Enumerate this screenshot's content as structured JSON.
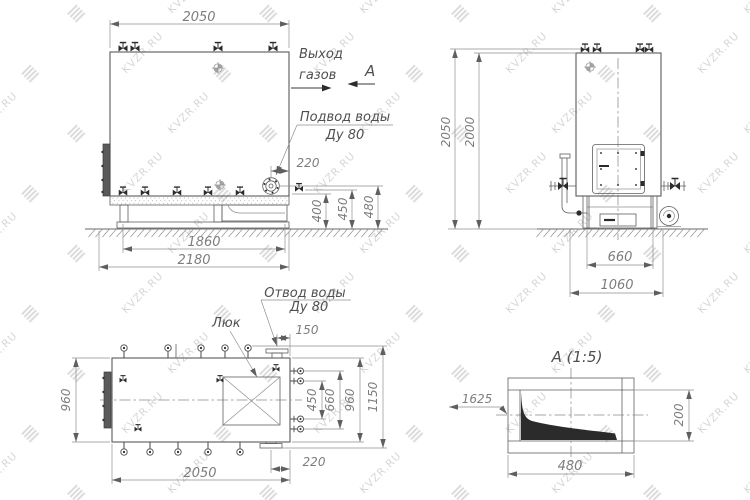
{
  "watermark": {
    "text": "KVZR.RU"
  },
  "front_view": {
    "gas_outlet_line1": "Выход",
    "gas_outlet_line2": "газов",
    "section_letter": "А",
    "water_supply_line1": "Подвод воды",
    "water_supply_line2": "Ду 80",
    "dim_width_top": "2050",
    "dim_nozzle_offset": "220",
    "dim_h400": "400",
    "dim_h450": "450",
    "dim_h480": "480",
    "dim_frame": "1860",
    "dim_base": "2180"
  },
  "side_view": {
    "dim_height_overall": "2050",
    "dim_height_shell": "2000",
    "dim_base_width": "660",
    "dim_overall_width": "1060"
  },
  "plan_view": {
    "hatch_label": "Люк",
    "water_outlet_line1": "Отвод воды",
    "water_outlet_line2": "Ду 80",
    "dim_150": "150",
    "dim_width_left": "960",
    "dim_450": "450",
    "dim_660": "660",
    "dim_960": "960",
    "dim_overall": "1150",
    "dim_length": "2050",
    "dim_220": "220"
  },
  "detail_view": {
    "title": "А (1:5)",
    "dim_level": "1625",
    "dim_height": "200",
    "dim_width": "480"
  }
}
